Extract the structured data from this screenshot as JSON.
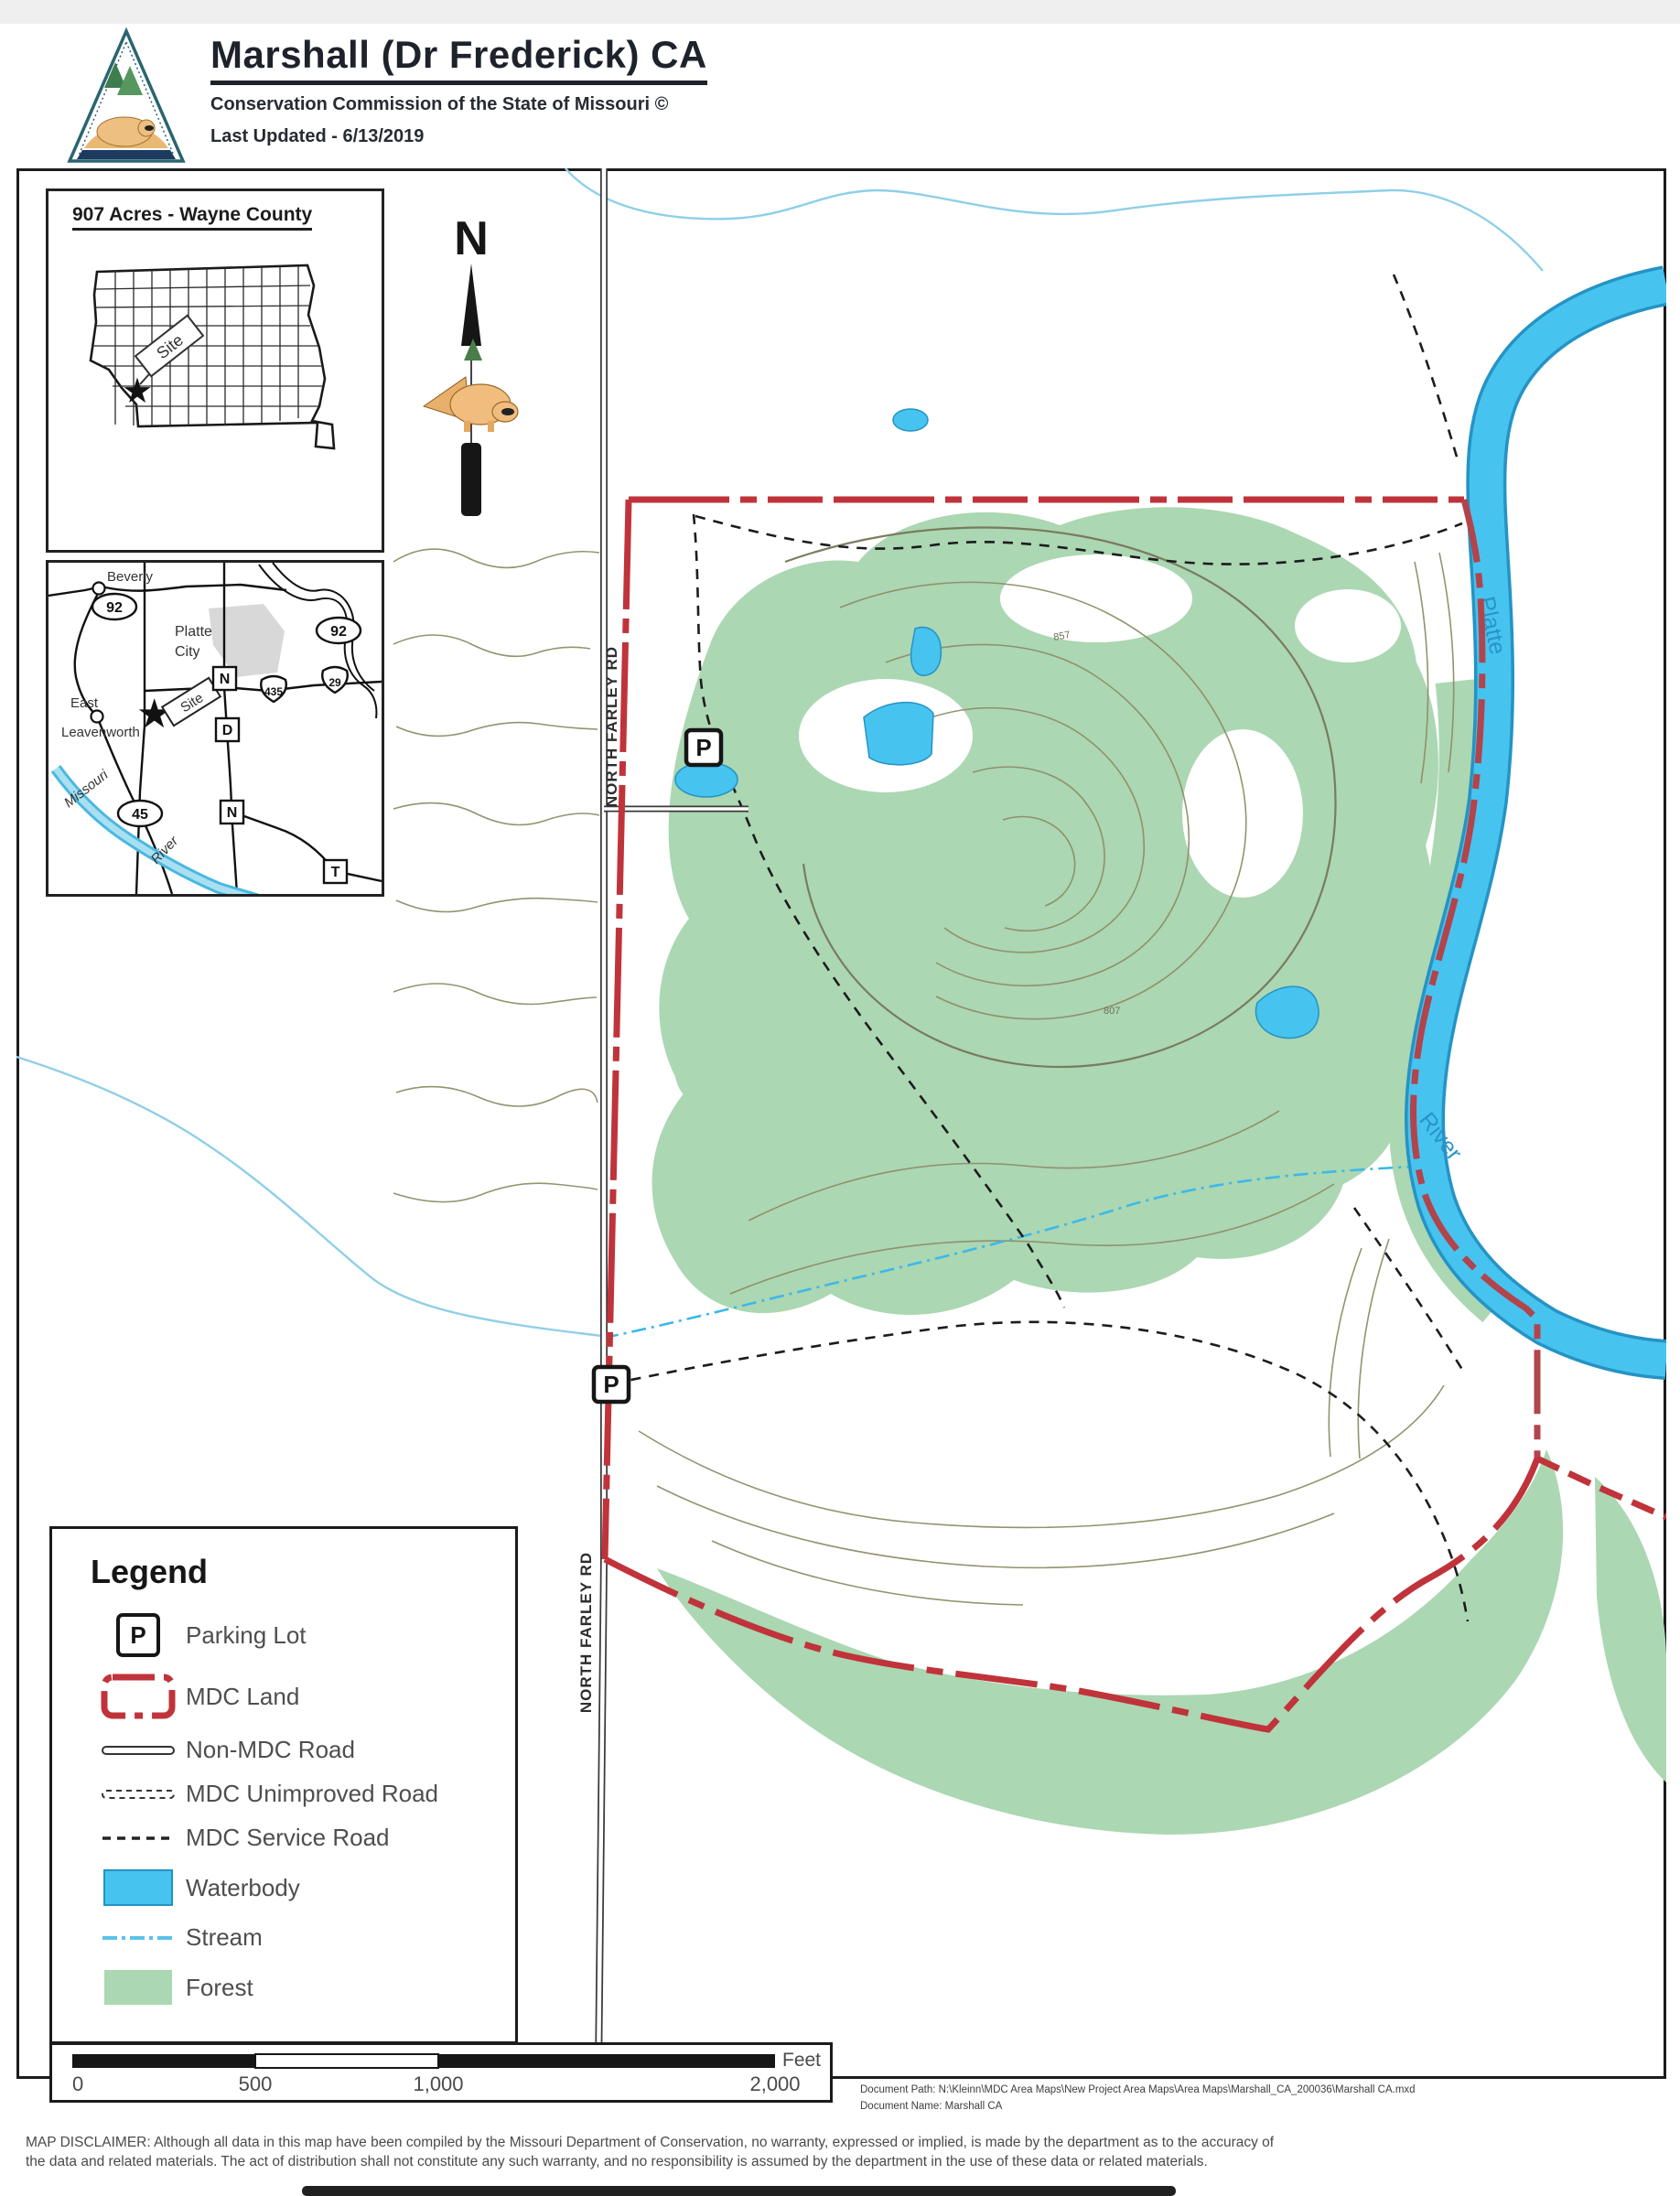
{
  "header": {
    "title": "Marshall (Dr Frederick) CA",
    "subtitle": "Conservation Commission of the State of Missouri ©",
    "last_updated": "Last Updated - 6/13/2019"
  },
  "north_arrow": {
    "label": "N"
  },
  "inset_state": {
    "title": "907 Acres - Wayne County",
    "site_label": "Site"
  },
  "inset_local": {
    "beverly": "Beverly",
    "platte_city_line1": "Platte",
    "platte_city_line2": "City",
    "east_line1": "East",
    "east_line2": "Leavenworth",
    "missouri_label": "Missouri",
    "river_label": "River",
    "site_label": "Site",
    "routes": {
      "r92a": "92",
      "r92b": "92",
      "r29": "29",
      "r435": "435",
      "r45": "45",
      "rN1": "N",
      "rD": "D",
      "rN2": "N",
      "rT": "T"
    }
  },
  "main_map": {
    "road_label_1": "NORTH FARLEY RD",
    "road_label_2": "NORTH FARLEY RD",
    "river_label_top": "Platte",
    "river_label_bottom": "River",
    "parking_1": "P",
    "parking_2": "P",
    "contour_label_1": "857",
    "contour_label_2": "807"
  },
  "legend": {
    "title": "Legend",
    "items": [
      {
        "icon": "parking-icon",
        "label": "Parking Lot"
      },
      {
        "icon": "mdc-land-icon",
        "label": "MDC Land"
      },
      {
        "icon": "non-mdc-road-icon",
        "label": "Non-MDC Road"
      },
      {
        "icon": "mdc-unimproved-icon",
        "label": "MDC Unimproved Road"
      },
      {
        "icon": "mdc-service-icon",
        "label": "MDC Service Road"
      },
      {
        "icon": "waterbody-icon",
        "label": "Waterbody"
      },
      {
        "icon": "stream-icon",
        "label": "Stream"
      },
      {
        "icon": "forest-icon",
        "label": "Forest"
      }
    ]
  },
  "scale_bar": {
    "ticks": [
      "0",
      "500",
      "1,000",
      "2,000"
    ],
    "unit": "Feet"
  },
  "footer": {
    "document_path": "Document Path: N:\\Kleinn\\MDC Area Maps\\New Project Area Maps\\Area Maps\\Marshall_CA_200036\\Marshall CA.mxd",
    "document_name": "Document Name: Marshall CA",
    "disclaimer_line1": "MAP DISCLAIMER: Although all data in this map have been compiled by the Missouri Department of Conservation, no warranty, expressed or implied, is made by the department as to the accuracy of",
    "disclaimer_line2": "the data and related materials. The act of distribution shall not constitute any such warranty, and no responsibility is assumed  by the department in the use of these data or related materials."
  },
  "colors": {
    "forest": "#abd7b2",
    "waterbody": "#47c3ef",
    "water_edge": "#2593c4",
    "boundary_red": "#c0333a",
    "stream": "#5bc2e8",
    "contour": "#8e8e68"
  }
}
